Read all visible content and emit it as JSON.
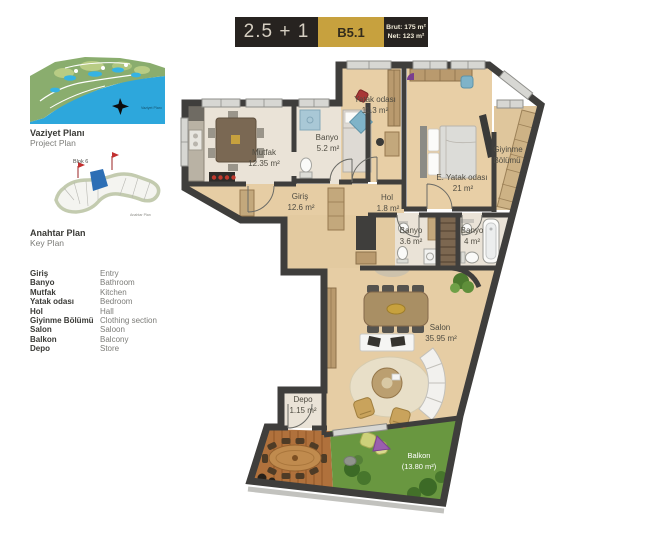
{
  "header": {
    "type_label": "2.5 + 1",
    "unit_code": "B5.1",
    "brut_label": "Brut: 175 m²",
    "net_label": "Net: 123 m²"
  },
  "site_plan": {
    "title_tr": "Vaziyet Planı",
    "title_en": "Project Plan",
    "map_caption": "Vaziyet Planı"
  },
  "key_plan": {
    "title_tr": "Anahtar Plan",
    "title_en": "Key Plan",
    "block_label": "Blok 6",
    "map_caption": "Anahtar Plan"
  },
  "legend": {
    "rows": [
      {
        "tr": "Giriş",
        "en": "Entry"
      },
      {
        "tr": "Banyo",
        "en": "Bathroom"
      },
      {
        "tr": "Mutfak",
        "en": "Kitchen"
      },
      {
        "tr": "Yatak odası",
        "en": "Bedroom"
      },
      {
        "tr": "Hol",
        "en": "Hall"
      },
      {
        "tr": "Giyinme Bölümü",
        "en": "Clothing section"
      },
      {
        "tr": "Salon",
        "en": "Saloon"
      },
      {
        "tr": "Balkon",
        "en": "Balcony"
      },
      {
        "tr": "Depo",
        "en": "Store"
      }
    ]
  },
  "plan": {
    "rooms": [
      {
        "id": "mutfak",
        "line1": "Mutfak",
        "line2": "12.35 m²"
      },
      {
        "id": "banyo-ust",
        "line1": "Banyo",
        "line2": "5.2 m²"
      },
      {
        "id": "yatak-odasi",
        "line1": "Yatak odası",
        "line2": "11.3 m²"
      },
      {
        "id": "e-yatak-odasi",
        "line1": "E. Yatak odası",
        "line2": "21 m²"
      },
      {
        "id": "giyinme-bolumu",
        "line1": "Giyinme",
        "line2": "Bölümü"
      },
      {
        "id": "giris",
        "line1": "Giriş",
        "line2": "12.6 m²"
      },
      {
        "id": "hol",
        "line1": "Hol",
        "line2": "1.8 m²"
      },
      {
        "id": "banyo-orta",
        "line1": "Banyo",
        "line2": "3.6 m²"
      },
      {
        "id": "banyo-ebeveyn",
        "line1": "Banyo",
        "line2": "4 m²"
      },
      {
        "id": "salon",
        "line1": "Salon",
        "line2": "35.95 m²"
      },
      {
        "id": "depo",
        "line1": "Depo",
        "line2": "1.15 m²"
      },
      {
        "id": "balkon",
        "line1": "Balkon",
        "line2": "(13.80 m²)"
      }
    ]
  },
  "colors": {
    "header_dark": "#272320",
    "accent_gold": "#c7a13e",
    "wall": "#3f3e3c",
    "wood_floor": "#e6cda4",
    "tile_floor": "#eae3d7",
    "deck": "#b0713c",
    "grass": "#699740",
    "sea_blue": "#2da7dc",
    "key_unit_blue": "#2d6fb5"
  }
}
